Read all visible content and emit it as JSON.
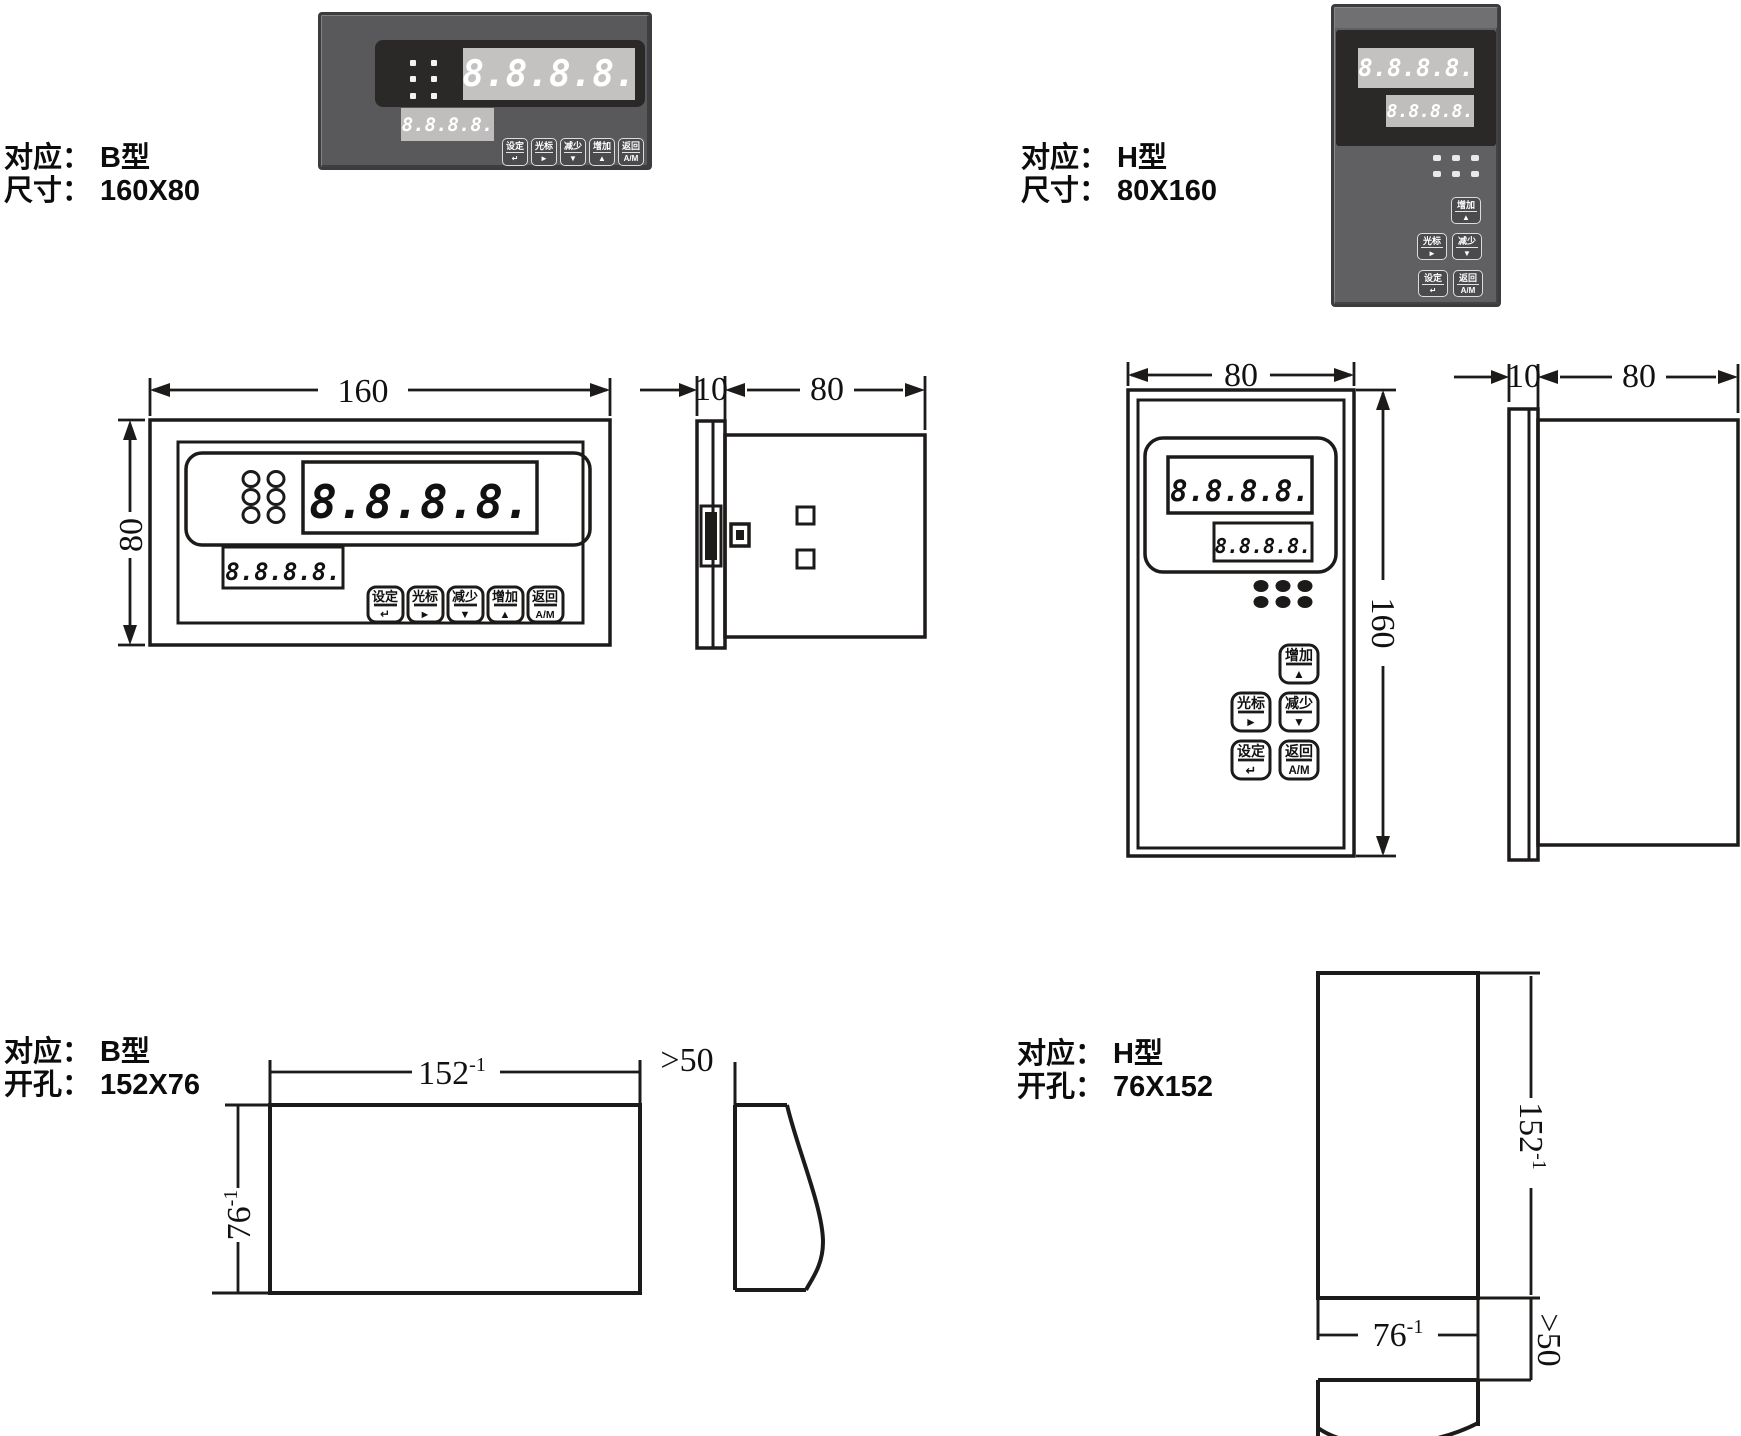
{
  "displays": {
    "value": "8.8.8.8."
  },
  "buttons": {
    "set": {
      "label": "设定",
      "symbol": "↵"
    },
    "cursor": {
      "label": "光标",
      "symbol": "►"
    },
    "decrease": {
      "label": "减少",
      "symbol": "▼"
    },
    "increase": {
      "label": "增加",
      "symbol": "▲"
    },
    "auto": {
      "label": "返回",
      "symbol": "A/M"
    }
  },
  "labels": {
    "b_size": {
      "l1p": "对应：",
      "l1v": "B型",
      "l2p": "尺寸：",
      "l2v": "160X80"
    },
    "h_size": {
      "l1p": "对应：",
      "l1v": "H型",
      "l2p": "尺寸：",
      "l2v": "80X160"
    },
    "b_cut": {
      "l1p": "对应：",
      "l1v": "B型",
      "l2p": "开孔：",
      "l2v": "152X76"
    },
    "h_cut": {
      "l1p": "对应：",
      "l1v": "H型",
      "l2p": "开孔：",
      "l2v": "76X152"
    }
  },
  "dims": {
    "b_front": {
      "w": "160",
      "h": "80"
    },
    "b_side": {
      "bezel": "10",
      "body": "80"
    },
    "h_front": {
      "w": "80",
      "h": "160"
    },
    "h_side": {
      "bezel": "10",
      "body": "80"
    },
    "b_cut": {
      "w": "152",
      "w_sup": "-1",
      "h": "76",
      "h_sup": "-1",
      "gap": ">50"
    },
    "h_cut": {
      "h": "152",
      "h_sup": "-1",
      "w": "76",
      "w_sup": "-1",
      "gap": ">50"
    }
  },
  "colors": {
    "bezel": "#59595c",
    "display_bg": "#2b2927",
    "digit_panel": "#c3c2c1",
    "line": "#1d1b1a"
  }
}
